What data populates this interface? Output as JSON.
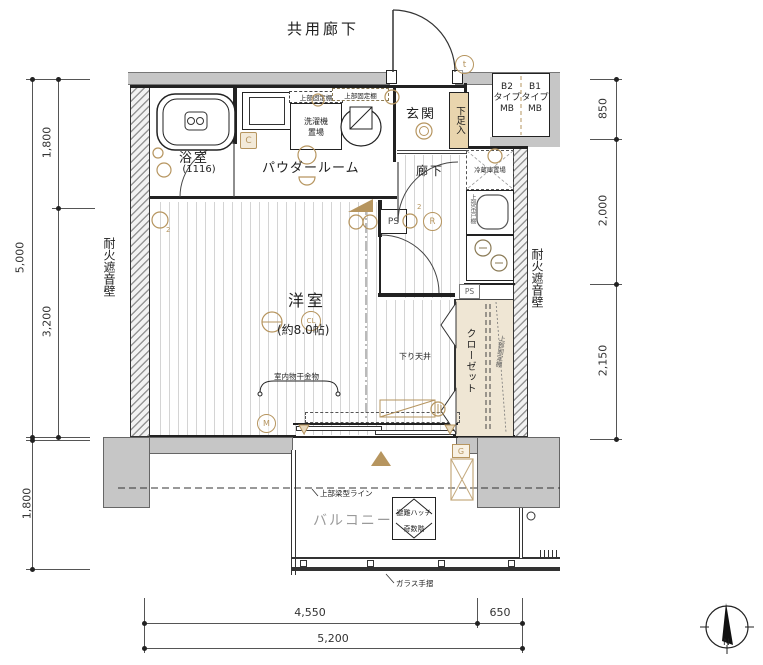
{
  "labels": {
    "common_corridor": "共用廊下",
    "entrance": "玄関",
    "shoe_cabinet": "下足入",
    "mb_left": {
      "l1": "B2",
      "l2": "タイプ",
      "l3": "MB"
    },
    "mb_right": {
      "l1": "B1",
      "l2": "タイプ",
      "l3": "MB"
    },
    "bathroom": "浴室",
    "bathroom_module": "(1116)",
    "powder_room": "パウダールーム",
    "upper_fixed_shelf": "上部固定棚",
    "washer_line1": "洗濯機",
    "washer_line2": "置場",
    "hallway": "廊下",
    "fridge_space": "冷蔵庫置場",
    "kitchen_upper_cupboard": "上部吊戸棚",
    "ps": "PS",
    "western_room": "洋室",
    "western_room_size": "(約8.0帖)",
    "lowered_ceiling": "下り天井",
    "indoor_drying_fixture": "室内物干金物",
    "closet": "クローゼット",
    "fire_sound_wall": "耐火遮音壁",
    "balcony": "バルコニー",
    "beam_line": "上部梁型ライン",
    "evac_hatch_line1": "避難ハッチ",
    "evac_hatch_line2": "奇数階",
    "glass_rail": "ガラス手摺",
    "badge_t": "t",
    "badge_c": "C",
    "badge_r": "R",
    "badge_g": "G",
    "badge_cl": "CL",
    "badge_m": "M",
    "badge_2": "2",
    "compass_north": "N"
  },
  "dimensions": {
    "left_upper": "1,800",
    "left_lower": "3,200",
    "left_total": "5,000",
    "left_balcony": "1,800",
    "right_top": "850",
    "right_middle": "2,000",
    "right_bottom": "2,150",
    "bottom_main": "4,550",
    "bottom_side": "650",
    "bottom_total": "5,200"
  },
  "colors": {
    "wall_gray": "#c6c6c6",
    "accent_tan": "#b6955f",
    "closet_fill": "#efe6d4",
    "shoe_box_fill": "#e9d5ae",
    "floor_line": "#d4d4d4",
    "balcony_label_gray": "#9a9a9a"
  }
}
